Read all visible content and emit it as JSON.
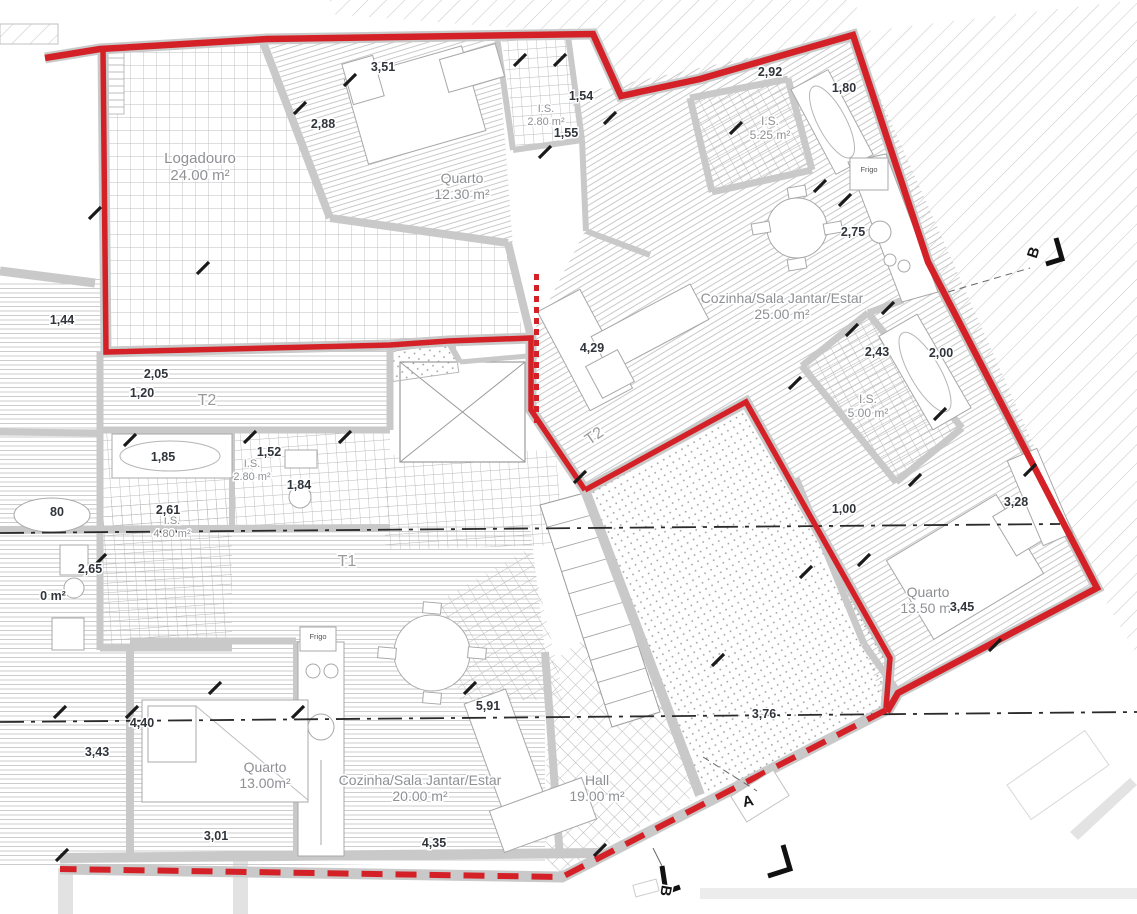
{
  "drawing": {
    "type": "architectural-floor-plan",
    "units_note": "m²"
  },
  "colors": {
    "boundary_red": "#d42127",
    "wall_gray": "#c9c9c9",
    "floor_line": "#c4c4c4",
    "dim_text": "#30343b",
    "room_text": "#8e9094",
    "marker_text": "#141414"
  },
  "rooms": [
    {
      "name": "Logadouro",
      "area": "24.00 m²",
      "x": 200,
      "y": 163,
      "size": 15
    },
    {
      "name": "Quarto",
      "area": "12.30 m²",
      "x": 462,
      "y": 183,
      "size": 14
    },
    {
      "name": "I.S.",
      "area": "2.80 m²",
      "x": 546,
      "y": 112,
      "size": 11
    },
    {
      "name": "I.S.",
      "area": "5.25 m²",
      "x": 770,
      "y": 125,
      "size": 12
    },
    {
      "name": "Cozinha/Sala Jantar/Estar",
      "area": "25.00 m²",
      "x": 782,
      "y": 303,
      "size": 14
    },
    {
      "name": "I.S.",
      "area": "5.00 m²",
      "x": 868,
      "y": 403,
      "size": 12
    },
    {
      "name": "Quarto",
      "area": "13.50 m²",
      "x": 928,
      "y": 597,
      "size": 14
    },
    {
      "name": "I.S.",
      "area": "2.80 m²",
      "x": 252,
      "y": 467,
      "size": 11
    },
    {
      "name": "I.S.",
      "area": "4.80 m²",
      "x": 172,
      "y": 524,
      "size": 11
    },
    {
      "name": "Quarto",
      "area": "13.00m²",
      "x": 265,
      "y": 772,
      "size": 14
    },
    {
      "name": "Cozinha/Sala Jantar/Estar",
      "area": "20.00 m²",
      "x": 420,
      "y": 785,
      "size": 14
    },
    {
      "name": "Hall",
      "area": "19.00 m²",
      "x": 597,
      "y": 785,
      "size": 14
    }
  ],
  "unit_labels": [
    {
      "text": "T2",
      "x": 207,
      "y": 405,
      "rotate": 0
    },
    {
      "text": "T2",
      "x": 597,
      "y": 440,
      "rotate": -35
    },
    {
      "text": "T1",
      "x": 347,
      "y": 566,
      "rotate": 0
    }
  ],
  "appliances": [
    {
      "text": "Frigo",
      "x": 869,
      "y": 172
    },
    {
      "text": "Frigo",
      "x": 318,
      "y": 639
    }
  ],
  "dimensions": [
    {
      "text": "3,51",
      "x": 383,
      "y": 71
    },
    {
      "text": "2,88",
      "x": 323,
      "y": 128
    },
    {
      "text": "1,54",
      "x": 581,
      "y": 100
    },
    {
      "text": "1,55",
      "x": 566,
      "y": 137
    },
    {
      "text": "2,92",
      "x": 770,
      "y": 76
    },
    {
      "text": "1,80",
      "x": 844,
      "y": 92
    },
    {
      "text": "2,75",
      "x": 853,
      "y": 236
    },
    {
      "text": "4,29",
      "x": 592,
      "y": 352
    },
    {
      "text": "2,43",
      "x": 877,
      "y": 356
    },
    {
      "text": "2,00",
      "x": 941,
      "y": 357
    },
    {
      "text": "1,00",
      "x": 844,
      "y": 513
    },
    {
      "text": "3,28",
      "x": 1016,
      "y": 506
    },
    {
      "text": "3,45",
      "x": 962,
      "y": 611
    },
    {
      "text": "1,44",
      "x": 62,
      "y": 324
    },
    {
      "text": "2,05",
      "x": 156,
      "y": 378
    },
    {
      "text": "1,20",
      "x": 142,
      "y": 397
    },
    {
      "text": "1,85",
      "x": 163,
      "y": 461
    },
    {
      "text": "1,52",
      "x": 269,
      "y": 456
    },
    {
      "text": "1,84",
      "x": 299,
      "y": 489
    },
    {
      "text": "2,61",
      "x": 168,
      "y": 514
    },
    {
      "text": "2,65",
      "x": 90,
      "y": 573
    },
    {
      "text": "80",
      "x": 57,
      "y": 516
    },
    {
      "text": "0 m²",
      "x": 53,
      "y": 600
    },
    {
      "text": "4,40",
      "x": 142,
      "y": 727
    },
    {
      "text": "3,43",
      "x": 97,
      "y": 756
    },
    {
      "text": "3,01",
      "x": 216,
      "y": 840
    },
    {
      "text": "4,35",
      "x": 434,
      "y": 847
    },
    {
      "text": "5,91",
      "x": 488,
      "y": 710
    },
    {
      "text": "3,76",
      "x": 764,
      "y": 718
    }
  ],
  "section_markers": [
    {
      "label": "B",
      "x": 1038,
      "y": 254,
      "rotate": -72
    },
    {
      "label": "A",
      "x": 749,
      "y": 806,
      "rotate": -12
    },
    {
      "label": "B",
      "x": 661,
      "y": 890,
      "rotate": 100
    }
  ]
}
